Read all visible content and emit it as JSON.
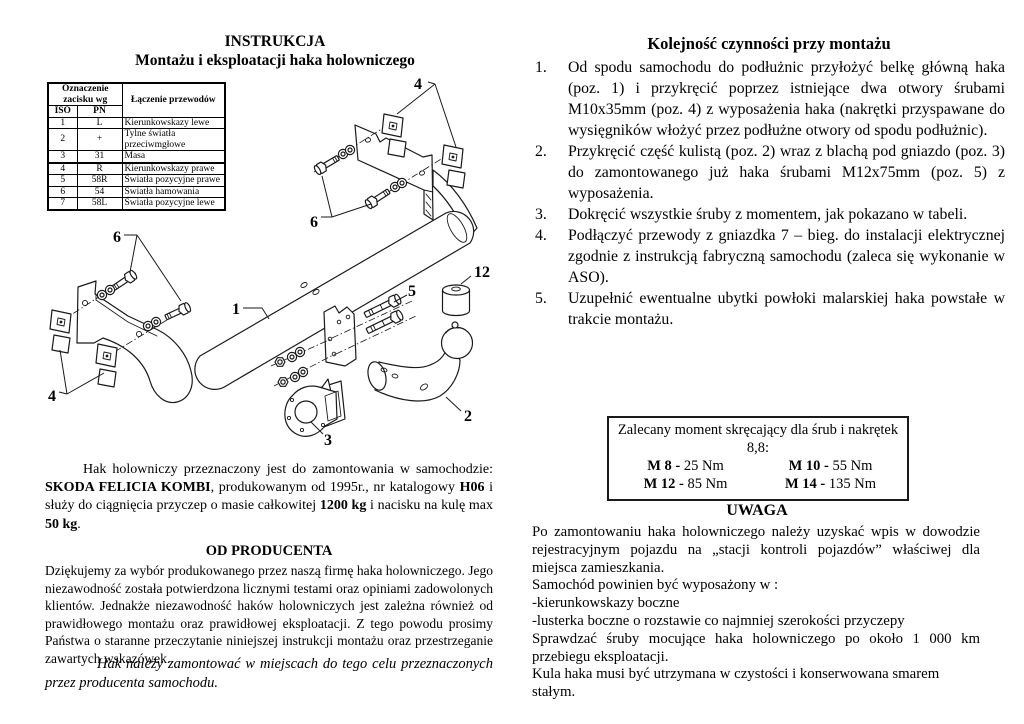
{
  "left": {
    "title_line1": "INSTRUKCJA",
    "title_line2": "Montażu i eksploatacji haka holowniczego",
    "table": {
      "header_group": "Oznaczenie zacisku wg",
      "header_desc": "Łączenie przewodów",
      "col_iso": "ISO",
      "col_pn": "PN",
      "rows": [
        [
          "1",
          "L",
          "Kierunkowskazy lewe"
        ],
        [
          "2",
          "+",
          "Tylne światła przeciwmgłowe"
        ],
        [
          "3",
          "31",
          "Masa"
        ],
        [
          "4",
          "R",
          "Kierunkowskazy prawe"
        ],
        [
          "5",
          "58R",
          "Światła pozycyjne prawe"
        ],
        [
          "6",
          "54",
          "Światła hamowania"
        ],
        [
          "7",
          "58L",
          "Światła pozycyjne lewe"
        ]
      ]
    },
    "intro_segments": [
      {
        "text": "Hak holowniczy przeznaczony jest do zamontowania w samochodzie: ",
        "bold": false
      },
      {
        "text": "SKODA FELICIA KOMBI",
        "bold": true
      },
      {
        "text": ", produkowanym od 1995r., nr katalogowy ",
        "bold": false
      },
      {
        "text": "H06",
        "bold": true
      },
      {
        "text": " i służy do ciągnięcia przyczep o masie całkowitej ",
        "bold": false
      },
      {
        "text": "1200 kg",
        "bold": true
      },
      {
        "text": " i nacisku na kulę max ",
        "bold": false
      },
      {
        "text": "50 kg",
        "bold": true
      },
      {
        "text": ".",
        "bold": false
      }
    ],
    "producer_heading": "OD PRODUCENTA",
    "producer_text": "Dziękujemy za wybór produkowanego przez naszą firmę haka holowniczego. Jego niezawodność została potwierdzona licznymi testami oraz opiniami zadowolonych klientów. Jednakże niezawodność haków holowniczych jest zależna również od prawidłowego montażu oraz prawidłowej eksploatacji. Z tego powodu prosimy Państwa o staranne przeczytanie niniejszej instrukcji montażu oraz przestrzeganie zawartych wskazówek.",
    "italic_note": "Hak należy zamontować w miejscach do tego celu przeznaczonych przez producenta samochodu."
  },
  "diagram": {
    "labels": {
      "beam": "1",
      "ball_arm": "2",
      "socket_plate": "3",
      "weld_nuts": "4",
      "bolts_m12": "5",
      "bolts_m10": "6",
      "ball_cap": "12"
    }
  },
  "right": {
    "title": "Kolejność czynności przy montażu",
    "steps": [
      {
        "num": "1.",
        "text": "Od spodu samochodu do podłużnic przyłożyć belkę główną haka (poz. 1) i przykręcić poprzez istniejące dwa otwory śrubami M10x35mm (poz. 4) z wyposażenia haka (nakrętki przyspawane do wysięgników włożyć przez podłużne otwory od spodu podłużnic)."
      },
      {
        "num": "2.",
        "text": "Przykręcić część kulistą (poz. 2) wraz z blachą pod gniazdo (poz. 3) do zamontowanego już haka śrubami M12x75mm (poz. 5) z wyposażenia."
      },
      {
        "num": "3.",
        "text": "Dokręcić wszystkie śruby z momentem, jak pokazano w tabeli."
      },
      {
        "num": "4.",
        "text": "Podłączyć przewody z gniazdka 7 – bieg. do instalacji elektrycznej zgodnie z instrukcją fabryczną samochodu (zaleca się wykonanie w ASO)."
      },
      {
        "num": "5.",
        "text": "Uzupełnić ewentualne ubytki powłoki malarskiej haka powstałe w trakcie montażu."
      }
    ],
    "torque_box": {
      "title": "Zalecany moment skręcający dla śrub i nakrętek 8,8:",
      "entries": [
        {
          "bolt": "M 8",
          "value": "25 Nm"
        },
        {
          "bolt": "M 10",
          "value": "55 Nm"
        },
        {
          "bolt": "M 12",
          "value": "85 Nm"
        },
        {
          "bolt": "M 14",
          "value": "135 Nm"
        }
      ]
    },
    "uwaga_heading": "UWAGA",
    "uwaga_paragraphs": [
      {
        "text": "Po zamontowaniu haka holowniczego należy uzyskać wpis w dowodzie rejestracyjnym pojazdu na „stacji kontroli pojazdów” właściwej dla miejsca zamieszkania.",
        "justify": true
      },
      {
        "text": "Samochód powinien być wyposażony w :",
        "justify": false
      },
      {
        "text": "-kierunkowskazy boczne",
        "justify": false
      },
      {
        "text": "-lusterka boczne o rozstawie co najmniej szerokości przyczepy",
        "justify": false
      },
      {
        "text": "Sprawdzać śruby mocujące haka holowniczego po około 1 000 km przebiegu eksploatacji.",
        "justify": true
      },
      {
        "text": "Kula haka musi być utrzymana w czystości i konserwowana smarem stałym.",
        "justify": false
      }
    ]
  }
}
